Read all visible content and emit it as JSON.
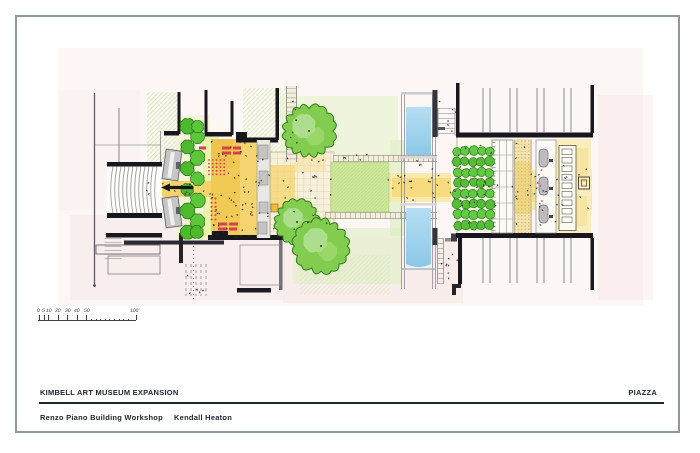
{
  "sheet": {
    "project_title": "KIMBELL ART MUSEUM EXPANSION",
    "sheet_name": "PIAZZA",
    "architect": "Renzo Piano Building Workshop",
    "associate_architect": "Kendall Heaton"
  },
  "scale_bar": {
    "tick_labels": [
      "0",
      "5",
      "10",
      "20",
      "30",
      "40",
      "50"
    ],
    "end_label": "100'"
  },
  "colors": {
    "border": "#8f9c96",
    "ink": "#20262e",
    "wall": "#17171d",
    "tree_outline": "#2d7c18",
    "pool_blue": "#8cc8e8",
    "chair_red": "#d8404e"
  }
}
